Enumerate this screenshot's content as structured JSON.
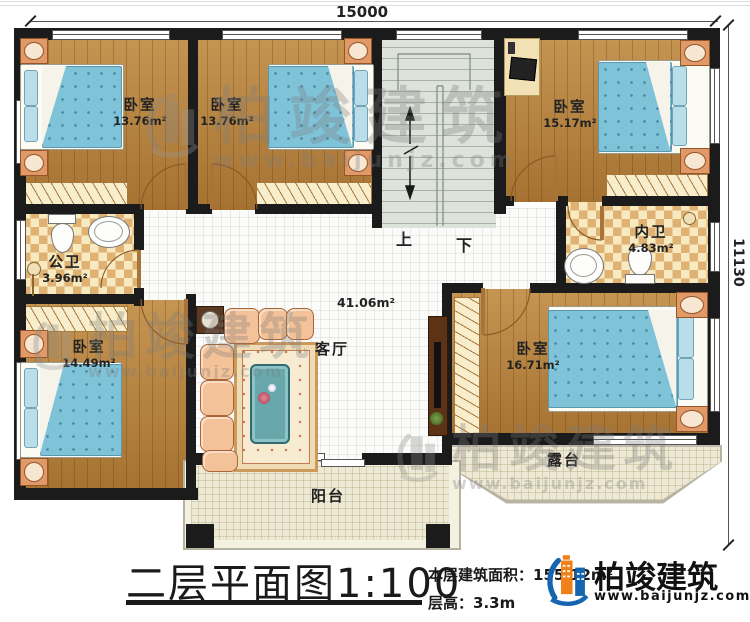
{
  "dimension_top": "15000",
  "dimension_right": "11130",
  "rooms": {
    "bedroom_tl": {
      "name": "卧室",
      "area": "13.76m²"
    },
    "bedroom_tm": {
      "name": "卧室",
      "area": "13.76m²"
    },
    "bedroom_tr": {
      "name": "卧室",
      "area": "15.17m²"
    },
    "bedroom_bl": {
      "name": "卧室",
      "area": "14.49m²"
    },
    "bedroom_br": {
      "name": "卧室",
      "area": "16.71m²"
    },
    "bath_public": {
      "name": "公卫",
      "area": "3.96m²"
    },
    "bath_ensuite": {
      "name": "内卫",
      "area": "4.83m²"
    },
    "living": {
      "name": "客厅",
      "area": "41.06m²"
    },
    "balcony": {
      "name": "阳台"
    },
    "terrace": {
      "name": "露台"
    }
  },
  "stairs": {
    "up": "上",
    "down": "下"
  },
  "title_block": {
    "title": "二层平面图1:100",
    "area_label": "本层建筑面积：",
    "area_value": "155.12m²",
    "height_label": "层高：",
    "height_value": "3.3m"
  },
  "brand": {
    "name": "柏竣建筑",
    "url": "www.baijunjz.com"
  },
  "watermark": {
    "name": "柏竣建筑",
    "url": "www.baijunjz.com"
  },
  "colors": {
    "wall": "#1b1b1b",
    "wood_floor": "#b5813c",
    "bed": "#7fc3d8",
    "tile_accent": "#dfb273",
    "brand_orange": "#f08018",
    "brand_blue": "#1565b0"
  }
}
